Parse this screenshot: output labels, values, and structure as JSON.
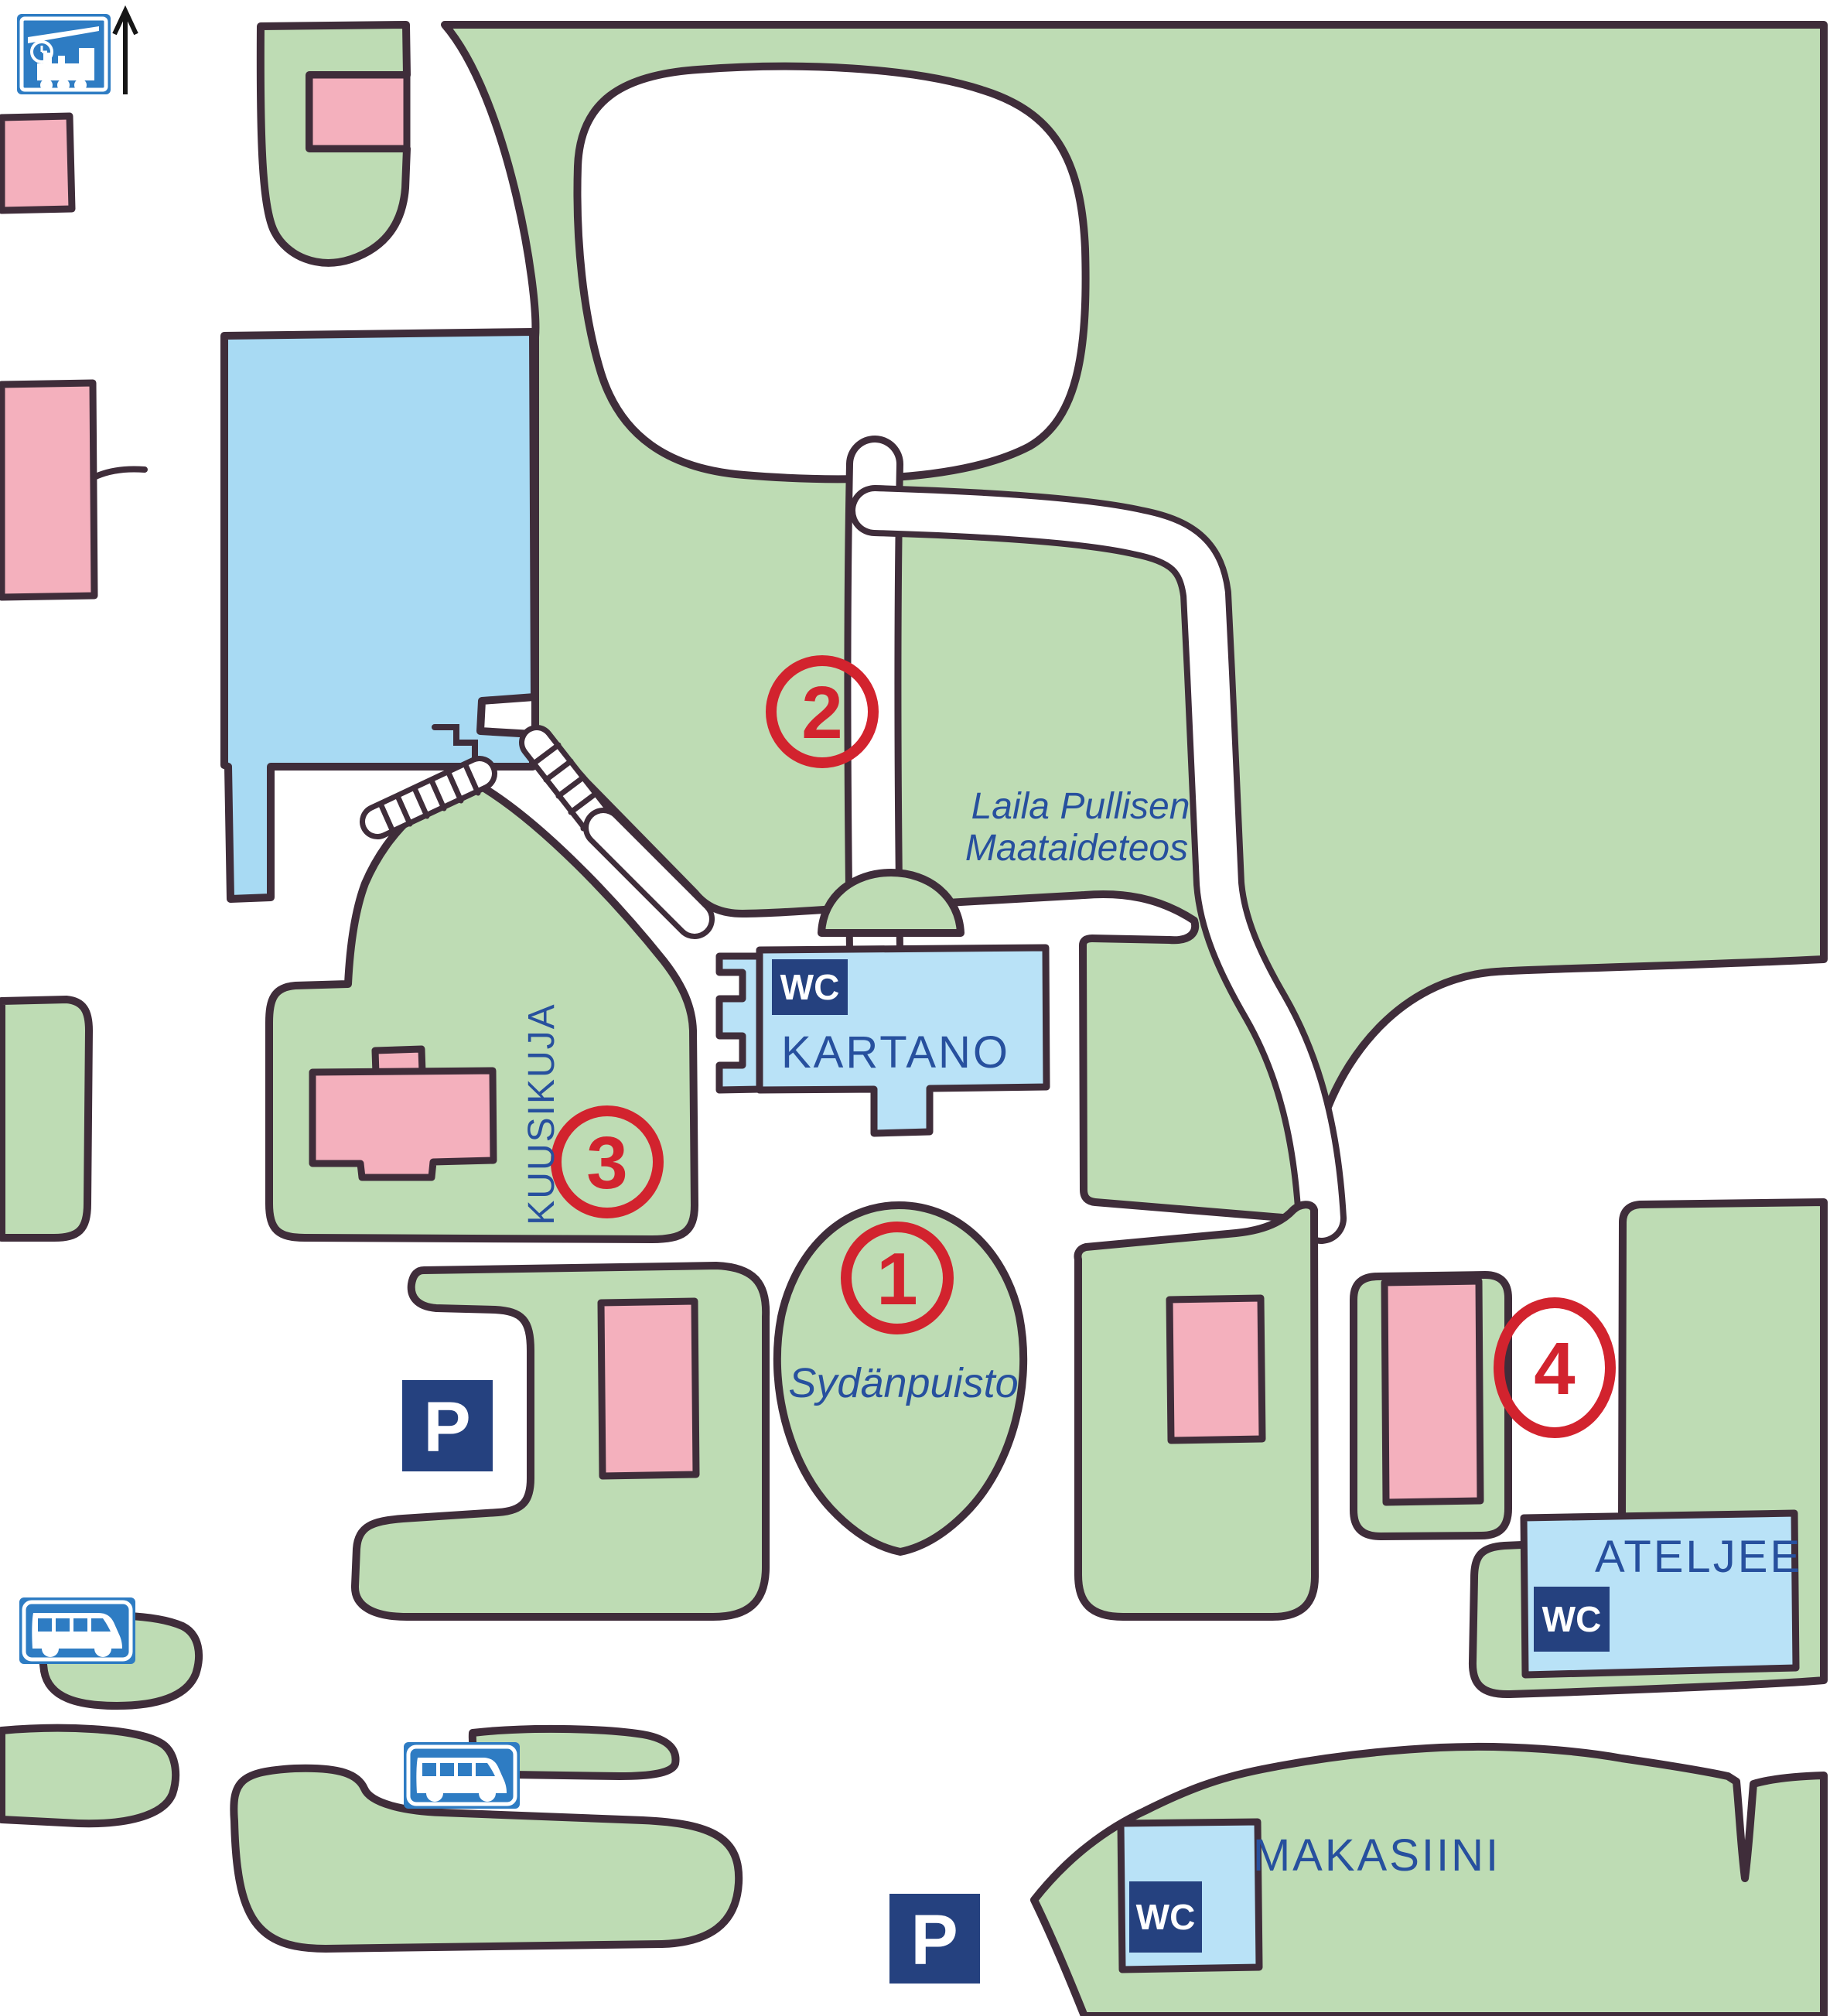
{
  "map_title": "park-visitor-map",
  "labels": {
    "kartano": "KARTANO",
    "kuusikuja": "KUUSIKUJA",
    "sydanpuisto": "Sydänpuisto",
    "ateljee": "ATELJEE",
    "makasiini": "MAKASIINI",
    "land_art_line1": "Laila Pullisen",
    "land_art_line2": "Maataideteos",
    "wc": "WC",
    "parking": "P"
  },
  "markers": [
    {
      "number": "1"
    },
    {
      "number": "2"
    },
    {
      "number": "3"
    },
    {
      "number": "4"
    }
  ],
  "icons": [
    "train-station-sign-icon",
    "north-arrow-icon",
    "bus-stop-sign-icon",
    "parking-sign-icon",
    "wc-badge",
    "stairs-hatching"
  ],
  "colors": {
    "park_green": "#bedcb4",
    "outline_ink": "#3f2d3a",
    "water_blue": "#a8daf3",
    "building_blue": "#b9e2f7",
    "building_pink": "#f4b0bd",
    "sign_navy": "#25417f",
    "traffic_sign_blue": "#2e7cc3",
    "marker_red": "#d2232e",
    "label_blue": "#27509e",
    "background": "#ffffff"
  }
}
